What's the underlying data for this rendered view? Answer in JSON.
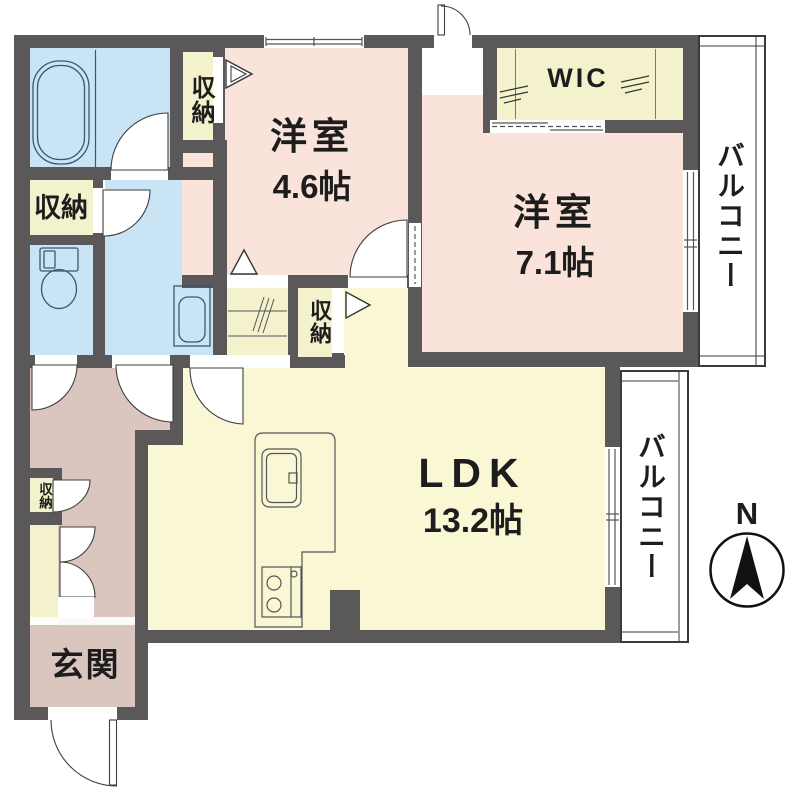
{
  "plan": {
    "type": "apartment-floor-plan",
    "rooms": {
      "bedroom1": {
        "label": "洋室",
        "area": "4.6帖"
      },
      "bedroom2": {
        "label": "洋室",
        "area": "7.1帖"
      },
      "ldk": {
        "label": "LDK",
        "area": "13.2帖"
      },
      "entrance": {
        "label": "玄関"
      },
      "wic": {
        "label": "WIC"
      },
      "storage": {
        "label": "収納"
      },
      "balcony": {
        "label": "バルコニー"
      }
    },
    "compass": {
      "north": "N"
    }
  },
  "colors": {
    "wall": "#5a5858",
    "pink": "#fae3da",
    "yellow": "#faf8d4",
    "closet": "#f4f1cd",
    "blue": "#c9e4f4",
    "mauve": "#dac5bf",
    "line": "#444444",
    "icon": "#3d566e",
    "text": "#1d1d1d"
  }
}
